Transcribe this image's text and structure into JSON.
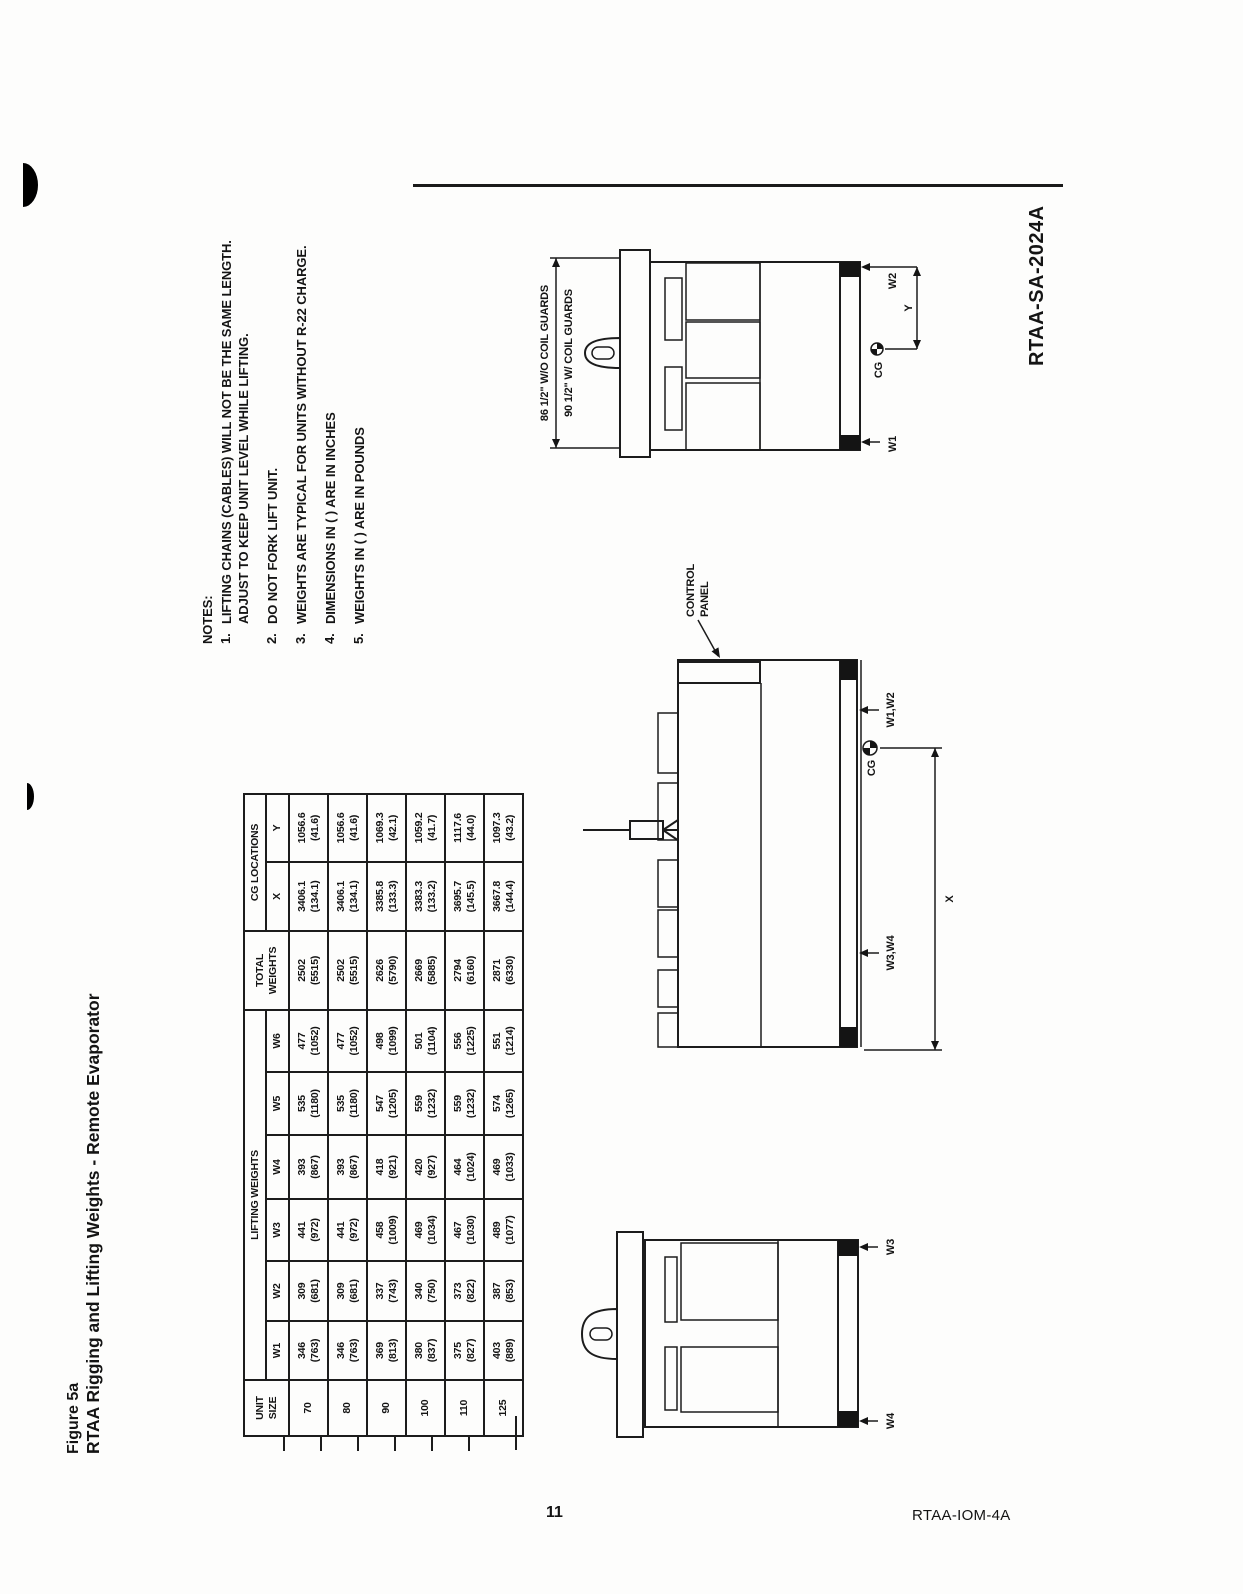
{
  "page": {
    "number": "11",
    "footer_right": "RTAA-IOM-4A",
    "drawing_number": "RTAA-SA-2024A"
  },
  "title": {
    "figure_label": "Figure 5a",
    "figure_title": "RTAA Rigging and Lifting Weights - Remote Evaporator"
  },
  "notes": {
    "heading": "NOTES:",
    "items": [
      {
        "num": "1.",
        "lines": [
          "LIFTING CHAINS (CABLES) WILL NOT BE THE SAME LENGTH.",
          "ADJUST TO KEEP UNIT LEVEL WHILE LIFTING."
        ]
      },
      {
        "num": "2.",
        "lines": [
          "DO NOT FORK LIFT UNIT."
        ]
      },
      {
        "num": "3.",
        "lines": [
          "WEIGHTS ARE TYPICAL FOR UNITS WITHOUT R-22 CHARGE."
        ]
      },
      {
        "num": "4.",
        "lines": [
          "DIMENSIONS IN ( ) ARE IN INCHES"
        ]
      },
      {
        "num": "5.",
        "lines": [
          "WEIGHTS IN ( ) ARE IN POUNDS"
        ]
      }
    ]
  },
  "table": {
    "col_unit": "UNIT\nSIZE",
    "group_lifting": "LIFTING WEIGHTS",
    "col_total": "TOTAL\nWEIGHTS",
    "group_cg": "CG LOCATIONS",
    "weight_cols": [
      "W1",
      "W2",
      "W3",
      "W4",
      "W5",
      "W6"
    ],
    "cg_cols": [
      "X",
      "Y"
    ],
    "rows": [
      {
        "size": "70",
        "cells": [
          "346\n(763)",
          "309\n(681)",
          "441\n(972)",
          "393\n(867)",
          "535\n(1180)",
          "477\n(1052)",
          "2502\n(5515)",
          "3406.1\n(134.1)",
          "1056.6\n(41.6)"
        ]
      },
      {
        "size": "80",
        "cells": [
          "346\n(763)",
          "309\n(681)",
          "441\n(972)",
          "393\n(867)",
          "535\n(1180)",
          "477\n(1052)",
          "2502\n(5515)",
          "3406.1\n(134.1)",
          "1056.6\n(41.6)"
        ]
      },
      {
        "size": "90",
        "cells": [
          "369\n(813)",
          "337\n(743)",
          "458\n(1009)",
          "418\n(921)",
          "547\n(1205)",
          "498\n(1099)",
          "2626\n(5790)",
          "3385.8\n(133.3)",
          "1069.3\n(42.1)"
        ]
      },
      {
        "size": "100",
        "cells": [
          "380\n(837)",
          "340\n(750)",
          "469\n(1034)",
          "420\n(927)",
          "559\n(1232)",
          "501\n(1104)",
          "2669\n(5885)",
          "3383.3\n(133.2)",
          "1059.2\n(41.7)"
        ]
      },
      {
        "size": "110",
        "cells": [
          "375\n(827)",
          "373\n(822)",
          "467\n(1030)",
          "464\n(1024)",
          "559\n(1232)",
          "556\n(1225)",
          "2794\n(6160)",
          "3695.7\n(145.5)",
          "1117.6\n(44.0)"
        ]
      },
      {
        "size": "125",
        "cells": [
          "403\n(889)",
          "387\n(853)",
          "489\n(1077)",
          "469\n(1033)",
          "574\n(1265)",
          "551\n(1214)",
          "2871\n(6330)",
          "3667.8\n(144.4)",
          "1097.3\n(43.2)"
        ]
      }
    ]
  },
  "diagrams": {
    "side_view": {
      "control_panel_line1": "CONTROL",
      "control_panel_line2": "PANEL",
      "label_w1w2": "W1,W2",
      "label_w3w4": "W3,W4",
      "label_cg": "CG",
      "label_x": "X"
    },
    "end_view_front": {
      "dim_without_guards": "86 1/2\" W/O COIL GUARDS",
      "dim_with_guards": "90 1/2\" W/ COIL GUARDS",
      "label_w1": "W1",
      "label_w2": "W2",
      "label_cg": "CG",
      "label_y": "Y"
    },
    "end_view_rear": {
      "label_w3": "W3",
      "label_w4": "W4"
    }
  }
}
